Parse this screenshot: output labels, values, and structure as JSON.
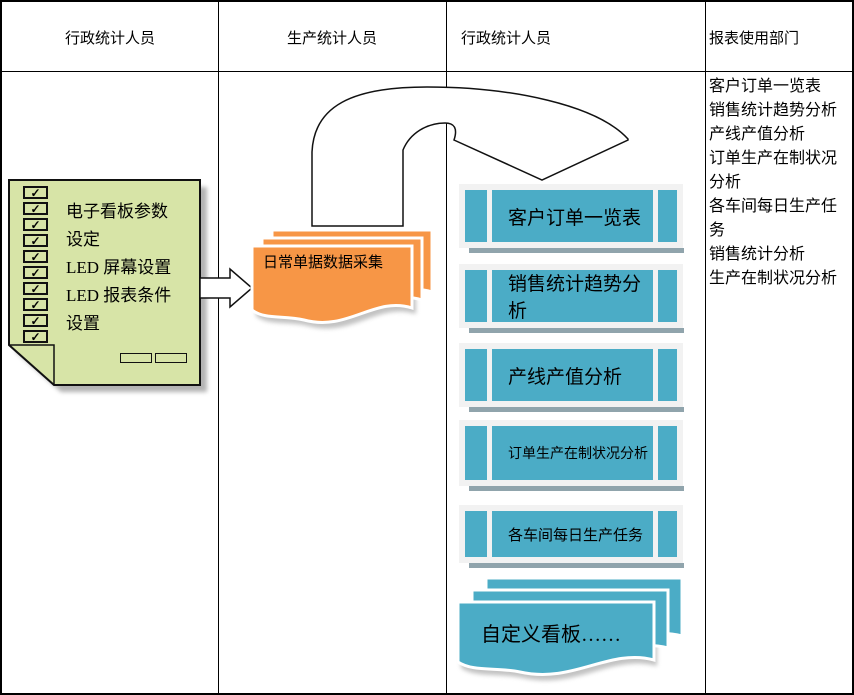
{
  "lanes": [
    {
      "label": "行政统计人员"
    },
    {
      "label": "生产统计人员"
    },
    {
      "label": "行政统计人员"
    },
    {
      "label": "报表使用部门"
    }
  ],
  "note": {
    "lines": [
      "电子看板参数",
      "设定",
      "LED 屏幕设置",
      "LED 报表条件",
      "设置"
    ],
    "check_glyph": "✓",
    "checkbox_count": 10
  },
  "flow": {
    "orange_doc_label": "日常单据数据采集",
    "teal_doc_label": "自定义看板……"
  },
  "blue_bars": [
    {
      "label": "客户订单一览表"
    },
    {
      "label": "销售统计趋势分析"
    },
    {
      "label": "产线产值分析"
    },
    {
      "label": "订单生产在制状况分析"
    },
    {
      "label": "各车间每日生产任务"
    }
  ],
  "report_list": [
    "客户订单一览表",
    "销售统计趋势分析",
    "产线产值分析",
    "订单生产在制状况分析",
    "各车间每日生产任务",
    "销售统计分析",
    "生产在制状况分析"
  ],
  "colors": {
    "teal": "#4BACC6",
    "orange": "#F79646",
    "note_green": "#D7E4A7",
    "bar_shadow": "#90A4AC",
    "bar_panel": "#F2F2F2"
  }
}
